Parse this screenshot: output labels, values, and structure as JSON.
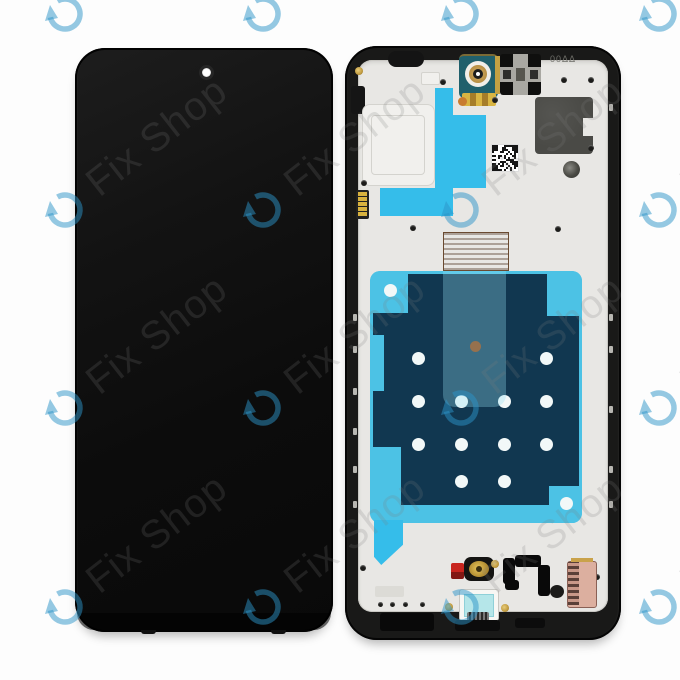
{
  "page": {
    "background": "#fdfdfd",
    "description": "Product photo: smartphone LCD display assembly, front screen (left) and back frame with components (right), on white background with tiled shop watermark"
  },
  "watermark": {
    "brand_text": "Fix Shop",
    "icon": "circular-rotate-arrow-icon",
    "icon_color": "rgba(44,148,200,0.50)",
    "text_color": "rgba(127,127,127,0.20)"
  },
  "left_panel": {
    "part": "display front glass, black, punch-hole camera top center"
  },
  "right_panel": {
    "part": "display back frame with adhesive sheets and flex components",
    "etched_marking": "00ΔΔ",
    "qr_code": "data-matrix label",
    "hole_grid_rows": 4,
    "hole_grid_cols": 4
  },
  "colors": {
    "tape_cyan": "#35bdea",
    "sheet_cyan": "#4cc2e5",
    "sheet_navy": "#113750",
    "copper": "#a87b55",
    "gold": "#c9a24a",
    "graphite": "#4a4a46",
    "red_component": "#c8251e",
    "pink_connector": "#dcaf9f",
    "camera_teal": "#20606c"
  }
}
